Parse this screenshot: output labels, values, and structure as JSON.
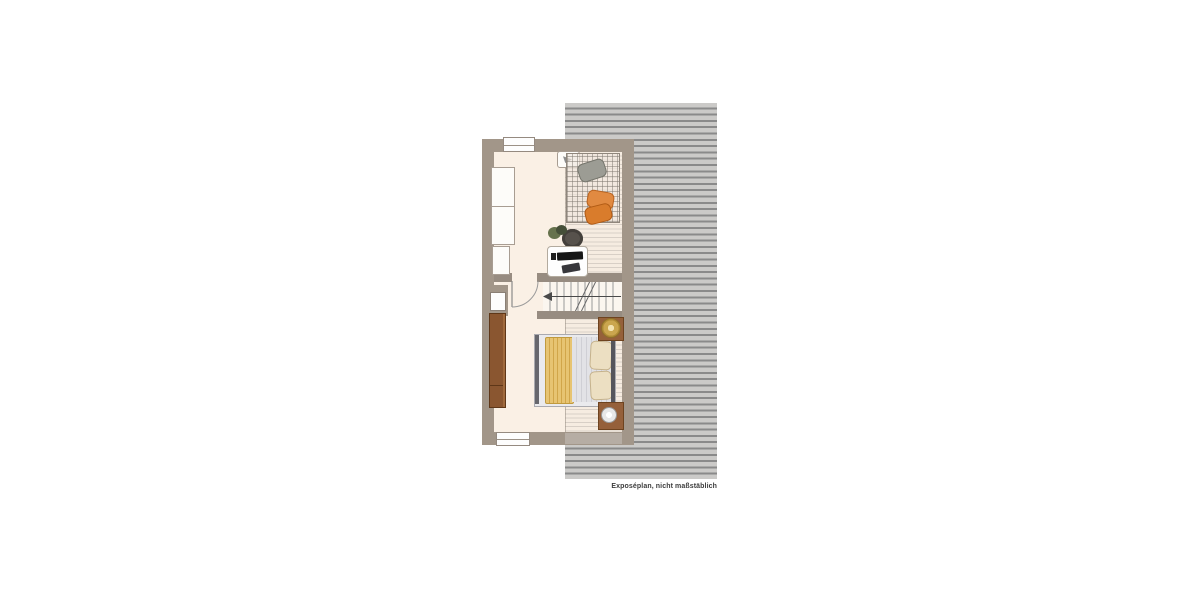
{
  "plan": {
    "type": "floor-plan",
    "caption": "Exposéplan, nicht maßstäblich"
  },
  "colors": {
    "background": "#ffffff",
    "wall": "#a29689",
    "interior_wall": "#978c81",
    "floor": "#faf0e5",
    "roof_stripe_light": "#cbcac8",
    "roof_stripe_dark": "#8a8a8a",
    "slope_stripe_line": "#d8cfc6",
    "wardrobe_wood": "#8a5630",
    "nightstand_wood": "#95603a",
    "duvet_gold": "#e7c472",
    "beanbag_orange": "#e18a41",
    "beanbag_gray": "#9c9c94",
    "lamp_gold": "#caa64e",
    "caption_text": "#3c3c3c"
  },
  "features": [
    "roof-hatch",
    "exterior-wall",
    "interior-wall",
    "window",
    "swing-door",
    "chimney-shaft",
    "staircase",
    "stair-direction-arrow",
    "built-in-cupboard",
    "radiator",
    "wall-tv",
    "rug",
    "beanbag-cushion",
    "plant",
    "desk",
    "desk-chair",
    "computer-monitor",
    "keyboard",
    "wardrobe",
    "double-bed",
    "pillow",
    "duvet",
    "nightstand",
    "table-lamp"
  ]
}
